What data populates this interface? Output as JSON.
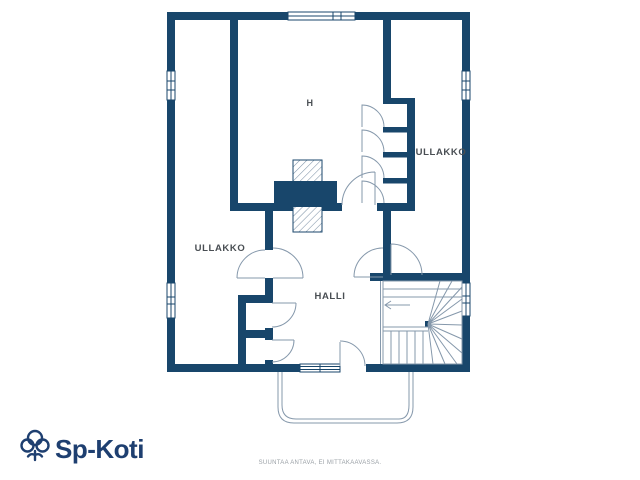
{
  "plan": {
    "room_labels": {
      "h": "H",
      "ullakko_right": "ULLAKKO",
      "ullakko_left": "ULLAKKO",
      "halli": "HALLI"
    },
    "colors": {
      "wall": "#18466b",
      "thin_line": "#8598ab",
      "label_text": "#494e53",
      "logo": "#1e3f70",
      "footer_text": "#9aa0a6"
    }
  },
  "branding": {
    "logo_text": "Sp-Koti"
  },
  "footer": {
    "disclaimer": "SUUNTAA ANTAVA, EI MITTAKAAVASSA."
  }
}
